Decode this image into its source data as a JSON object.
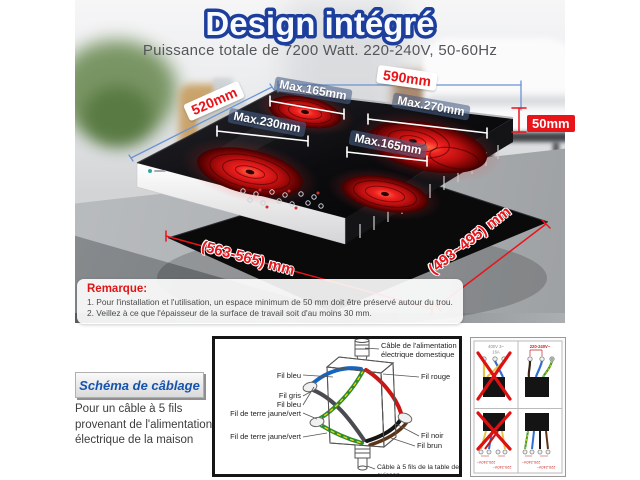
{
  "header": {
    "title": "Design intégré",
    "subtitle": "Puissance totale de 7200 Watt. 220-240V, 50-60Hz"
  },
  "dimensions": {
    "back_width": "590mm",
    "left_depth": "520mm",
    "thickness": "50mm",
    "burner_top_left": "Max.165mm",
    "burner_right": "Max.270mm",
    "burner_left": "Max.230mm",
    "burner_bottom": "Max.165mm",
    "cutout_width": "(563-565) mm",
    "cutout_depth": "(493~495) mm"
  },
  "remark": {
    "heading": "Remarque:",
    "line1": "1. Pour l'installation et l'utilisation, un espace minimum de 50 mm doit être préservé autour du trou.",
    "line2": "2. Veillez à ce que l'épaisseur de la surface de travail soit d'au moins 30 mm."
  },
  "wiring": {
    "button_label": "Schéma de câblage",
    "description": "Pour un câble à 5 fils provenant de l'alimentation électrique de la maison",
    "cable_top": "Câble de l'alimentation électrique domestique",
    "cable_bottom": "Câble à 5 fils de la table de cuisson",
    "labels_left": [
      "Fil bleu",
      "Fil gris",
      "Fil bleu",
      "Fil de terre jaune/vert",
      "Fil de terre jaune/vert"
    ],
    "labels_right": [
      "Fil rouge",
      "Fil noir",
      "Fil brun"
    ]
  },
  "panel": {
    "wrong_voltage": "400V 3~",
    "wrong_amps": "16A",
    "correct_voltage": "220-240V~"
  },
  "colors": {
    "accent_blue": "#1d3e9c",
    "accent_red": "#e8141a",
    "wire_blue": "#1565c0",
    "wire_gray": "#4a4a50",
    "wire_green": "#2e8b2e",
    "wire_yellow": "#ffd400",
    "wire_red": "#cc1414",
    "wire_black": "#151515",
    "wire_brown": "#5d3317"
  }
}
